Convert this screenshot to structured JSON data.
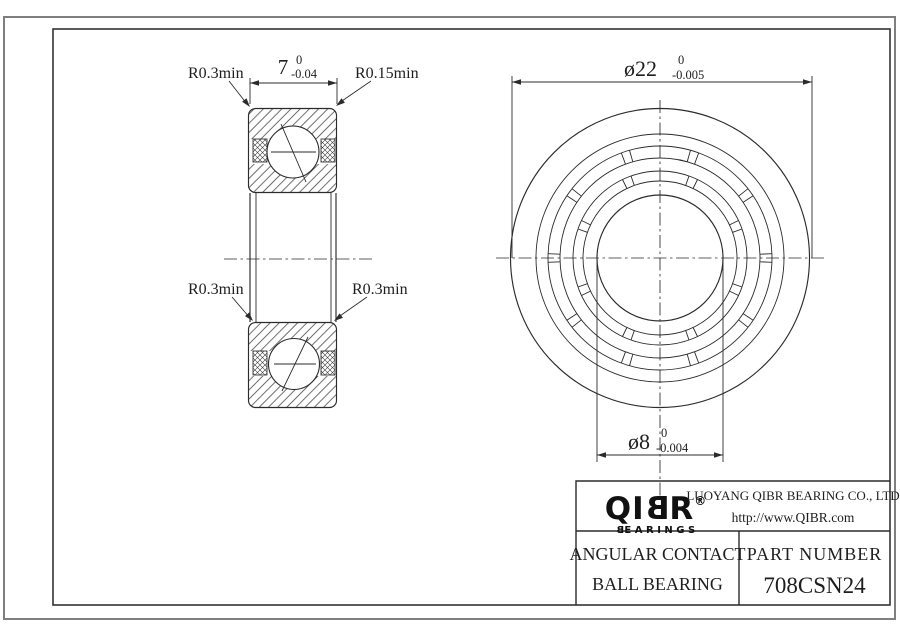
{
  "section_view": {
    "leader_top_left": "R0.3min",
    "leader_top_right": "R0.15min",
    "leader_mid_left": "R0.3min",
    "leader_mid_right": "R0.3min",
    "width_dim": {
      "nominal": "7",
      "upper_tol": "0",
      "lower_tol": "-0.04"
    }
  },
  "front_view": {
    "outer_dia_dim": {
      "nominal": "ø22",
      "upper_tol": "0",
      "lower_tol": "-0.005"
    },
    "bore_dia_dim": {
      "nominal": "ø8",
      "upper_tol": "0",
      "lower_tol": "-0.004"
    }
  },
  "title_block": {
    "logo_q": "Q",
    "logo_i": "I",
    "logo_b": "B",
    "logo_r": "R",
    "registered": "®",
    "logo_sub_b": "B",
    "logo_sub_rest": "EARINGS",
    "company": "LUOYANG QIBR BEARING CO., LTD",
    "website": "http://www.QIBR.com",
    "product_line1": "ANGULAR CONTACT",
    "product_line2": "BALL BEARING",
    "part_number_label": "PART NUMBER",
    "part_number": "708CSN24"
  },
  "colors": {
    "line": "#2b2b2b",
    "outer_border": "#7f7f7f",
    "background": "#ffffff"
  }
}
